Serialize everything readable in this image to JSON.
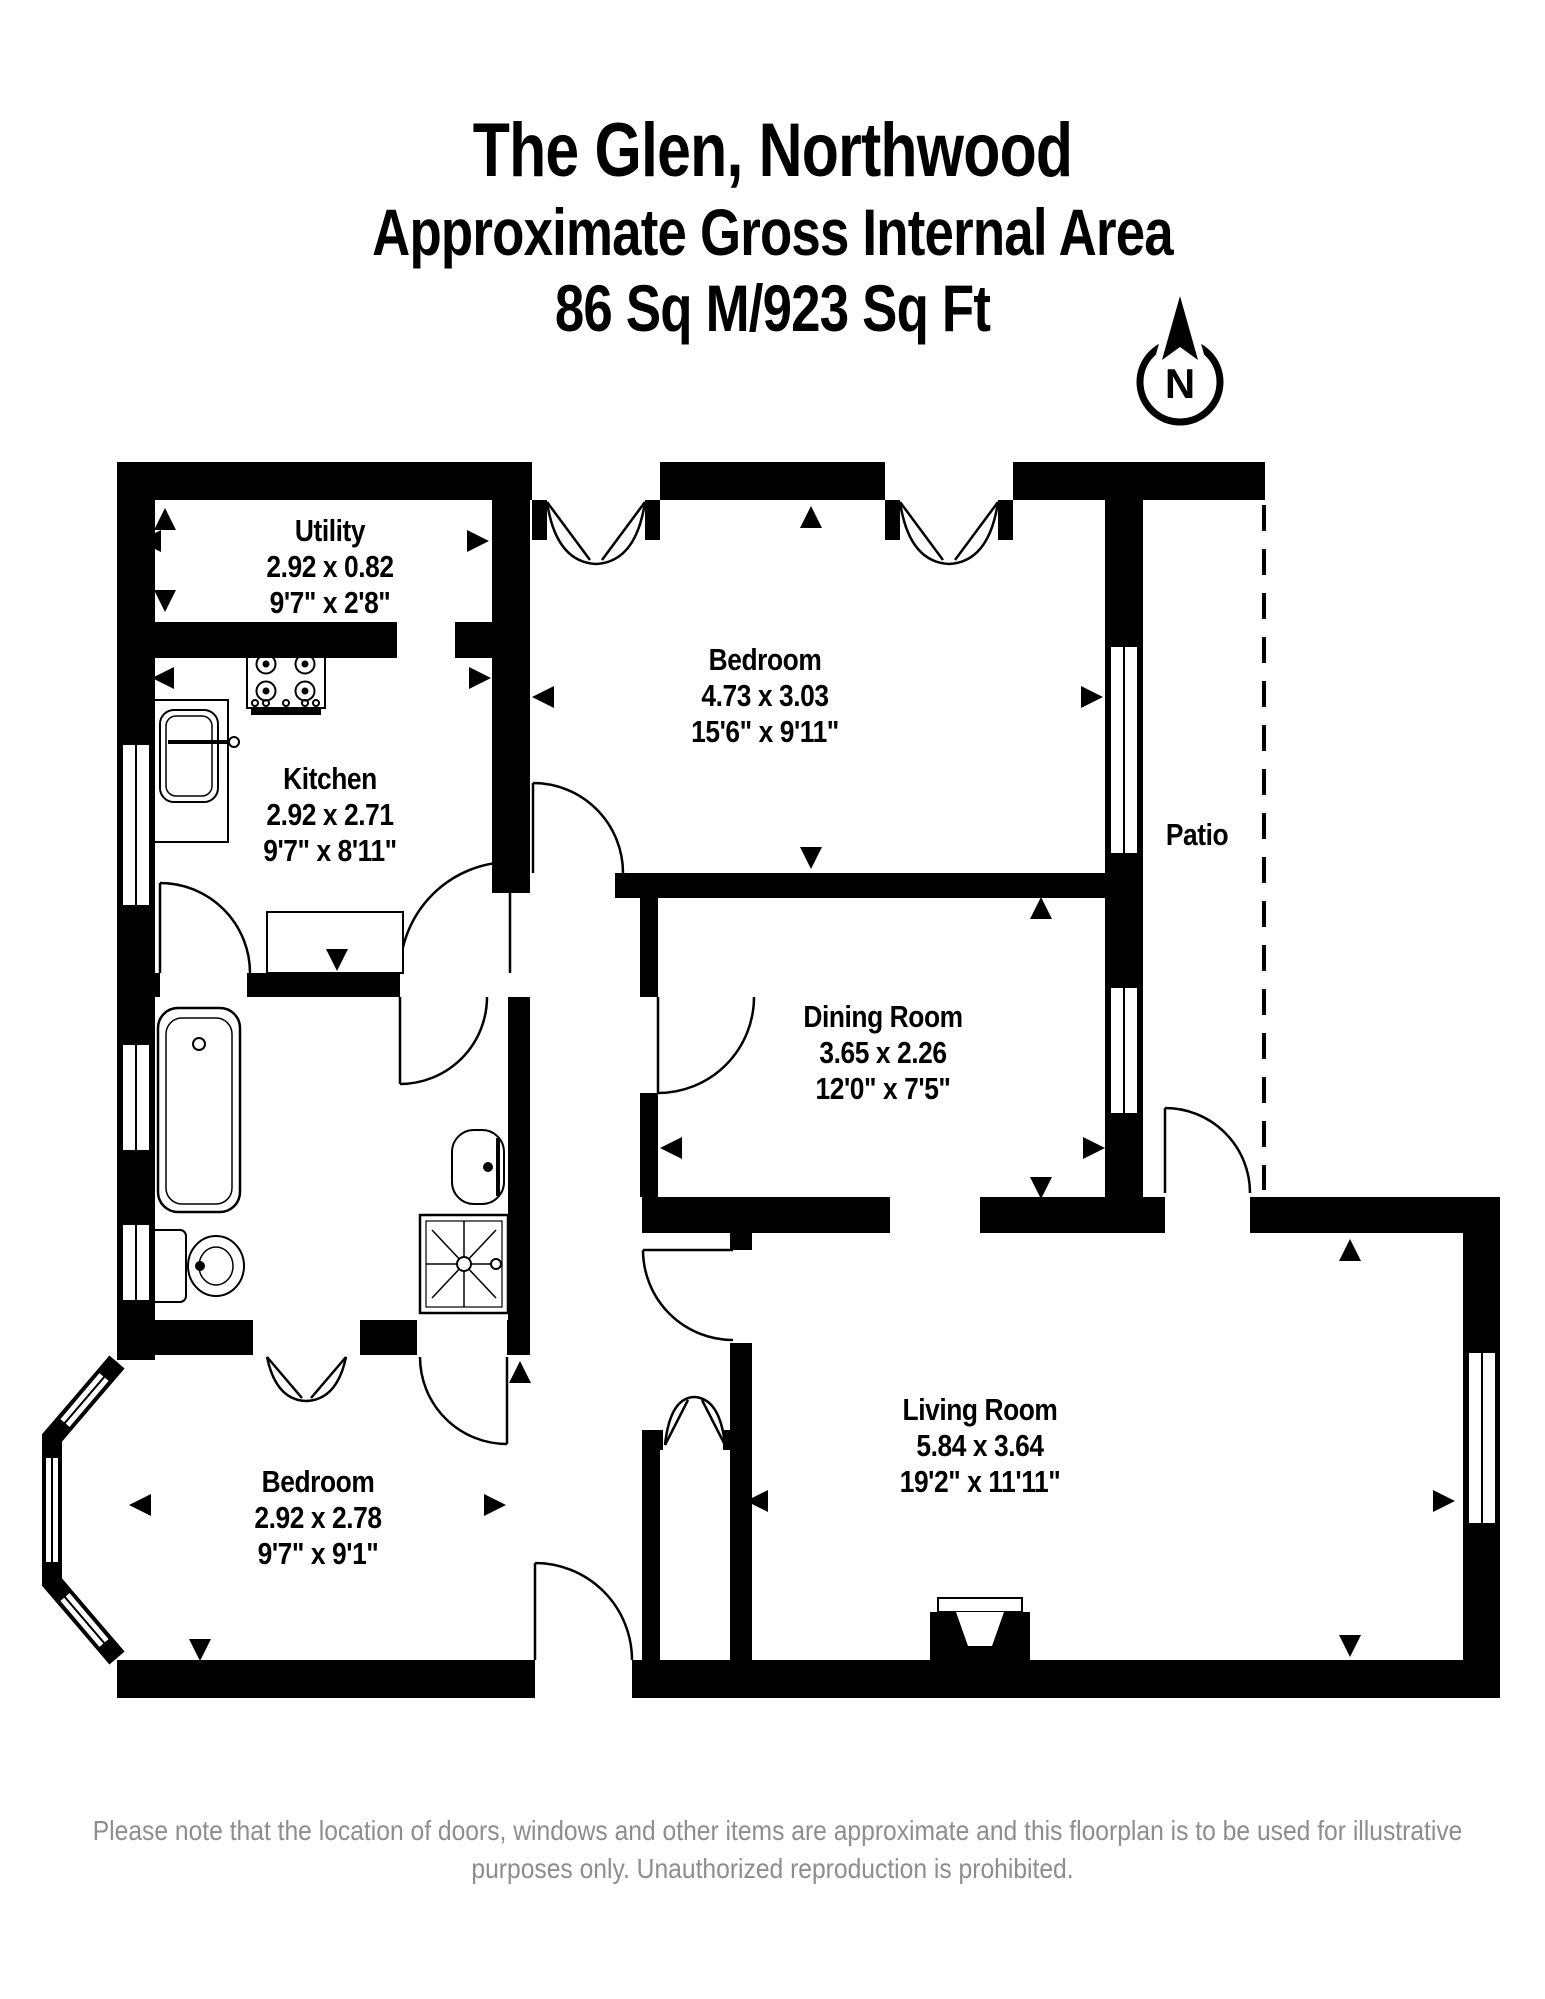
{
  "header": {
    "title": "The Glen, Northwood",
    "subtitle": "Approximate Gross Internal Area",
    "area": "86 Sq M/923 Sq Ft"
  },
  "compass": {
    "label": "N"
  },
  "rooms": [
    {
      "id": "utility",
      "name": "Utility",
      "metric": "2.92 x 0.82",
      "imperial": "9'7\" x 2'8\""
    },
    {
      "id": "kitchen",
      "name": "Kitchen",
      "metric": "2.92 x 2.71",
      "imperial": "9'7\" x 8'11\""
    },
    {
      "id": "bedroom1",
      "name": "Bedroom",
      "metric": "4.73 x 3.03",
      "imperial": "15'6\" x 9'11\""
    },
    {
      "id": "dining",
      "name": "Dining Room",
      "metric": "3.65 x 2.26",
      "imperial": "12'0\" x 7'5\""
    },
    {
      "id": "living",
      "name": "Living Room",
      "metric": "5.84 x 3.64",
      "imperial": "19'2\" x 11'11\""
    },
    {
      "id": "bedroom2",
      "name": "Bedroom",
      "metric": "2.92 x 2.78",
      "imperial": "9'7\" x 9'1\""
    },
    {
      "id": "patio",
      "name": "Patio"
    }
  ],
  "icons": {
    "compass": "north-arrow",
    "fixtures": [
      "hob-icon",
      "kitchen-sink-icon",
      "bathtub-icon",
      "toilet-icon",
      "washbasin-icon",
      "shower-icon",
      "fireplace-icon"
    ]
  },
  "footer": {
    "disclaimer_line1": "Please note that the location of doors, windows and other items are approximate and this floorplan is to be used for illustrative",
    "disclaimer_line2": "purposes only. Unauthorized reproduction is prohibited."
  },
  "colors": {
    "wall": "#000000",
    "text": "#000000",
    "muted": "#8d8d8d",
    "background": "#ffffff"
  }
}
